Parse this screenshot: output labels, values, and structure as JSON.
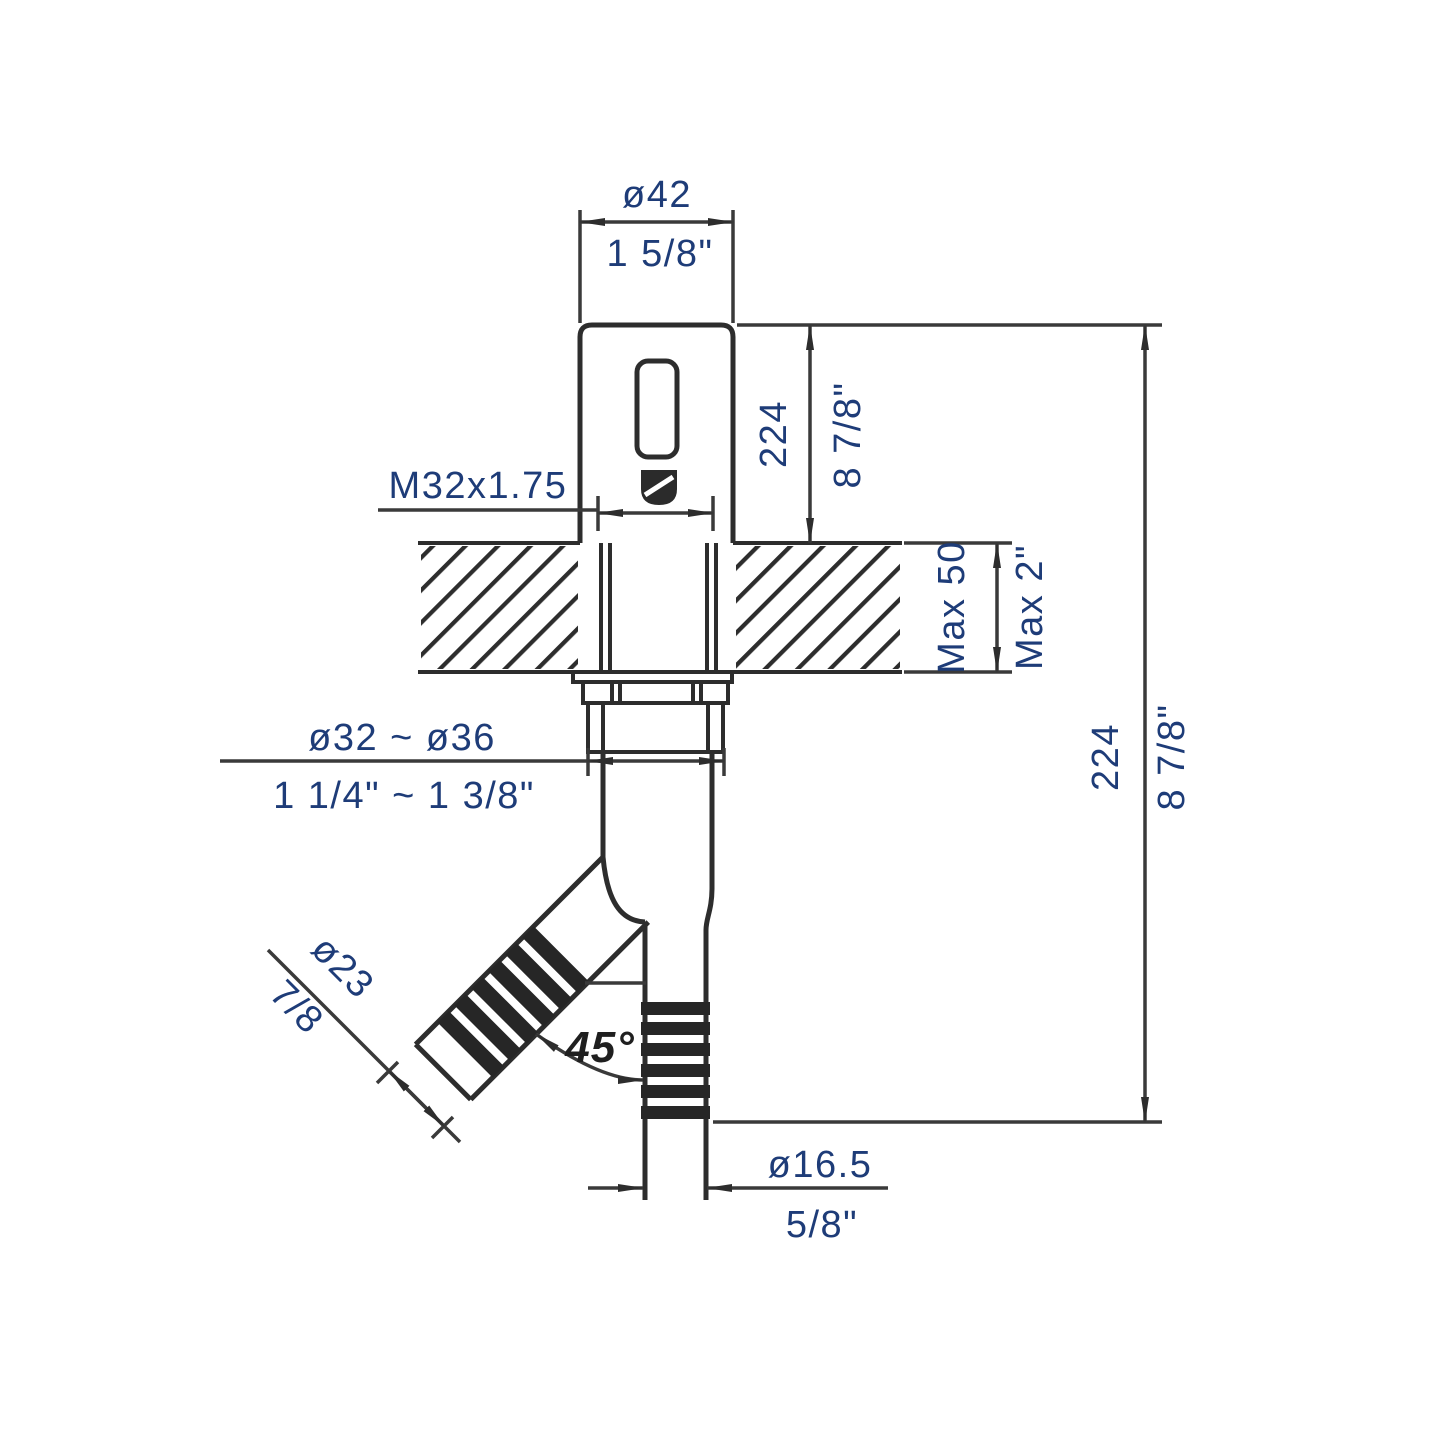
{
  "drawing": {
    "kind": "faucet-installation-dimension-drawing",
    "line_color": "#2d2d2d",
    "dim_text_color": "#1e3c78",
    "labels": {
      "top_diameter_mm": "ø42",
      "top_diameter_in": "1 5/8\"",
      "thread_spec": "M32x1.75",
      "body_height_mm": "224",
      "body_height_in": "8 7/8\"",
      "deck_thickness_mm": "Max 50",
      "deck_thickness_in": "Max 2\"",
      "shank_range_mm": "ø32 ~ ø36",
      "shank_range_in": "1 1/4\" ~ 1 3/8\"",
      "spout_diameter_mm": "ø23",
      "spout_diameter_in": "7/8",
      "spout_angle": "45°",
      "overall_height_mm": "224",
      "overall_height_in": "8 7/8\"",
      "outlet_diameter_mm": "ø16.5",
      "outlet_diameter_in": "5/8\""
    }
  }
}
